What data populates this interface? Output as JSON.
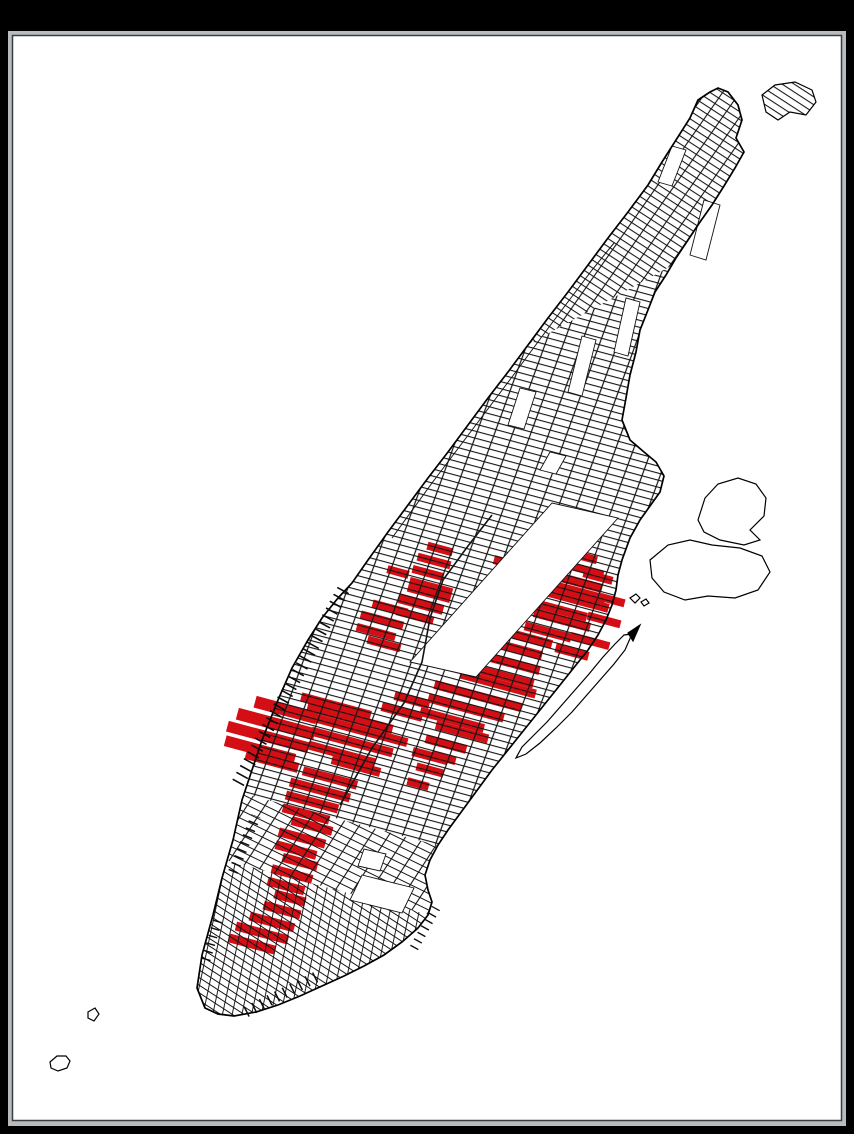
{
  "window": {
    "frame_color": "#000000",
    "bezel_color": "#b9bcbe",
    "bezel_edge_color": "#3a3d41",
    "canvas_color": "#ffffff"
  },
  "map": {
    "description": "street-network-map-of-manhattan-with-red-highlighted-blocks",
    "colors": {
      "street_line": "#141414",
      "coastline": "#000000",
      "highlight_red": "#d40e15",
      "park_fill": "#ffffff"
    },
    "coastline": [
      [
        205,
        1008
      ],
      [
        197,
        988
      ],
      [
        202,
        955
      ],
      [
        213,
        915
      ],
      [
        222,
        878
      ],
      [
        233,
        840
      ],
      [
        242,
        800
      ],
      [
        252,
        770
      ],
      [
        262,
        740
      ],
      [
        278,
        700
      ],
      [
        292,
        668
      ],
      [
        308,
        640
      ],
      [
        322,
        618
      ],
      [
        338,
        598
      ],
      [
        352,
        583
      ],
      [
        368,
        560
      ],
      [
        388,
        532
      ],
      [
        408,
        505
      ],
      [
        428,
        478
      ],
      [
        448,
        452
      ],
      [
        468,
        425
      ],
      [
        488,
        398
      ],
      [
        508,
        372
      ],
      [
        528,
        345
      ],
      [
        548,
        318
      ],
      [
        568,
        292
      ],
      [
        588,
        265
      ],
      [
        608,
        238
      ],
      [
        628,
        212
      ],
      [
        648,
        185
      ],
      [
        662,
        162
      ],
      [
        676,
        140
      ],
      [
        690,
        118
      ],
      [
        698,
        100
      ],
      [
        710,
        92
      ],
      [
        718,
        88
      ],
      [
        728,
        92
      ],
      [
        738,
        105
      ],
      [
        742,
        120
      ],
      [
        736,
        138
      ],
      [
        744,
        152
      ],
      [
        735,
        168
      ],
      [
        724,
        186
      ],
      [
        712,
        205
      ],
      [
        700,
        222
      ],
      [
        688,
        240
      ],
      [
        676,
        258
      ],
      [
        666,
        275
      ],
      [
        655,
        292
      ],
      [
        648,
        310
      ],
      [
        640,
        330
      ],
      [
        636,
        352
      ],
      [
        630,
        375
      ],
      [
        626,
        398
      ],
      [
        622,
        420
      ],
      [
        630,
        440
      ],
      [
        644,
        452
      ],
      [
        656,
        462
      ],
      [
        664,
        476
      ],
      [
        660,
        492
      ],
      [
        650,
        506
      ],
      [
        640,
        520
      ],
      [
        630,
        538
      ],
      [
        622,
        560
      ],
      [
        618,
        575
      ],
      [
        616,
        590
      ],
      [
        612,
        605
      ],
      [
        606,
        620
      ],
      [
        598,
        635
      ],
      [
        588,
        650
      ],
      [
        576,
        665
      ],
      [
        564,
        680
      ],
      [
        552,
        695
      ],
      [
        540,
        710
      ],
      [
        528,
        725
      ],
      [
        516,
        740
      ],
      [
        504,
        755
      ],
      [
        492,
        770
      ],
      [
        481,
        785
      ],
      [
        470,
        800
      ],
      [
        459,
        815
      ],
      [
        448,
        830
      ],
      [
        438,
        845
      ],
      [
        430,
        860
      ],
      [
        425,
        875
      ],
      [
        428,
        890
      ],
      [
        432,
        902
      ],
      [
        428,
        915
      ],
      [
        418,
        928
      ],
      [
        402,
        942
      ],
      [
        384,
        955
      ],
      [
        364,
        966
      ],
      [
        344,
        976
      ],
      [
        322,
        986
      ],
      [
        300,
        996
      ],
      [
        278,
        1005
      ],
      [
        256,
        1012
      ],
      [
        234,
        1016
      ],
      [
        218,
        1014
      ]
    ],
    "red_blocks": [
      [
        566,
        552,
        64,
        8
      ],
      [
        536,
        545,
        30,
        8
      ],
      [
        560,
        563,
        90,
        8
      ],
      [
        548,
        574,
        112,
        9
      ],
      [
        556,
        586,
        102,
        9
      ],
      [
        566,
        597,
        88,
        9
      ],
      [
        552,
        608,
        72,
        9
      ],
      [
        562,
        620,
        58,
        9
      ],
      [
        548,
        632,
        48,
        9
      ],
      [
        598,
        577,
        30,
        8
      ],
      [
        612,
        600,
        26,
        8
      ],
      [
        604,
        620,
        34,
        8
      ],
      [
        590,
        641,
        40,
        8
      ],
      [
        572,
        652,
        34,
        9
      ],
      [
        520,
        636,
        66,
        9
      ],
      [
        513,
        648,
        60,
        9
      ],
      [
        500,
        660,
        82,
        9
      ],
      [
        488,
        672,
        94,
        9
      ],
      [
        498,
        684,
        78,
        9
      ],
      [
        478,
        696,
        90,
        9
      ],
      [
        466,
        708,
        78,
        9
      ],
      [
        452,
        720,
        66,
        9
      ],
      [
        462,
        732,
        54,
        9
      ],
      [
        446,
        744,
        42,
        9
      ],
      [
        430,
        756,
        36,
        9
      ],
      [
        440,
        549,
        26,
        8
      ],
      [
        434,
        561,
        34,
        8
      ],
      [
        428,
        573,
        32,
        8
      ],
      [
        430,
        590,
        44,
        15
      ],
      [
        421,
        604,
        46,
        10
      ],
      [
        415,
        616,
        38,
        8
      ],
      [
        398,
        572,
        22,
        8
      ],
      [
        390,
        608,
        36,
        8
      ],
      [
        382,
        620,
        44,
        8
      ],
      [
        376,
        632,
        40,
        8
      ],
      [
        384,
        644,
        34,
        8
      ],
      [
        286,
        710,
        64,
        12
      ],
      [
        276,
        724,
        80,
        12
      ],
      [
        268,
        737,
        84,
        11
      ],
      [
        260,
        750,
        72,
        11
      ],
      [
        272,
        761,
        54,
        10
      ],
      [
        336,
        706,
        72,
        9
      ],
      [
        350,
        718,
        88,
        9
      ],
      [
        360,
        730,
        98,
        9
      ],
      [
        352,
        742,
        84,
        9
      ],
      [
        342,
        754,
        68,
        9
      ],
      [
        356,
        766,
        50,
        9
      ],
      [
        402,
        712,
        42,
        9
      ],
      [
        412,
        700,
        36,
        9
      ],
      [
        330,
        778,
        56,
        9
      ],
      [
        320,
        790,
        62,
        9
      ],
      [
        312,
        802,
        54,
        9
      ],
      [
        306,
        814,
        48,
        9
      ],
      [
        312,
        826,
        42,
        9
      ],
      [
        302,
        838,
        48,
        9
      ],
      [
        296,
        850,
        42,
        9
      ],
      [
        300,
        862,
        36,
        9
      ],
      [
        292,
        874,
        42,
        9
      ],
      [
        286,
        886,
        38,
        9
      ],
      [
        290,
        898,
        32,
        9
      ],
      [
        282,
        910,
        38,
        9
      ],
      [
        272,
        922,
        46,
        9
      ],
      [
        262,
        933,
        54,
        9
      ],
      [
        252,
        944,
        48,
        9
      ],
      [
        430,
        770,
        28,
        8
      ],
      [
        444,
        758,
        24,
        8
      ],
      [
        418,
        784,
        22,
        8
      ]
    ],
    "parks": [
      {
        "name": "central-park",
        "points": [
          [
            410,
            662
          ],
          [
            476,
            677
          ],
          [
            618,
            518
          ],
          [
            552,
            503
          ]
        ]
      },
      {
        "name": "morningside-park",
        "points": [
          [
            568,
            392
          ],
          [
            582,
            396
          ],
          [
            596,
            340
          ],
          [
            582,
            336
          ]
        ]
      },
      {
        "name": "st-nicholas-park",
        "points": [
          [
            614,
            352
          ],
          [
            628,
            356
          ],
          [
            640,
            302
          ],
          [
            626,
            298
          ]
        ]
      },
      {
        "name": "highbridge-park",
        "points": [
          [
            690,
            255
          ],
          [
            706,
            260
          ],
          [
            720,
            205
          ],
          [
            704,
            200
          ]
        ]
      },
      {
        "name": "fort-tryon-park",
        "points": [
          [
            658,
            182
          ],
          [
            672,
            186
          ],
          [
            686,
            150
          ],
          [
            672,
            146
          ]
        ]
      },
      {
        "name": "campus-block",
        "points": [
          [
            508,
            425
          ],
          [
            524,
            429
          ],
          [
            536,
            392
          ],
          [
            520,
            388
          ]
        ]
      },
      {
        "name": "stuyvesant-town",
        "points": [
          [
            350,
            900
          ],
          [
            402,
            913
          ],
          [
            414,
            888
          ],
          [
            362,
            875
          ]
        ]
      },
      {
        "name": "tompkins-square",
        "points": [
          [
            358,
            866
          ],
          [
            380,
            871
          ],
          [
            386,
            854
          ],
          [
            364,
            849
          ]
        ]
      },
      {
        "name": "marcus-garvey-park",
        "points": [
          [
            540,
            470
          ],
          [
            556,
            474
          ],
          [
            566,
            456
          ],
          [
            550,
            452
          ]
        ]
      }
    ],
    "satellite_islands": [
      {
        "name": "marble-hill",
        "points": [
          [
            762,
            95
          ],
          [
            775,
            85
          ],
          [
            795,
            82
          ],
          [
            812,
            90
          ],
          [
            816,
            102
          ],
          [
            806,
            115
          ],
          [
            790,
            112
          ],
          [
            778,
            120
          ],
          [
            766,
            112
          ]
        ],
        "pattern": "pat-st-top"
      },
      {
        "name": "wards-island",
        "points": [
          [
            650,
            560
          ],
          [
            668,
            545
          ],
          [
            690,
            540
          ],
          [
            712,
            545
          ],
          [
            740,
            548
          ],
          [
            762,
            556
          ],
          [
            770,
            572
          ],
          [
            758,
            590
          ],
          [
            735,
            598
          ],
          [
            708,
            596
          ],
          [
            685,
            600
          ],
          [
            664,
            592
          ],
          [
            652,
            578
          ]
        ]
      },
      {
        "name": "randalls-island",
        "points": [
          [
            698,
            520
          ],
          [
            705,
            498
          ],
          [
            718,
            484
          ],
          [
            738,
            478
          ],
          [
            756,
            484
          ],
          [
            766,
            498
          ],
          [
            764,
            516
          ],
          [
            750,
            530
          ],
          [
            760,
            540
          ],
          [
            744,
            545
          ],
          [
            720,
            540
          ],
          [
            704,
            532
          ]
        ]
      },
      {
        "name": "roosevelt-sliver",
        "points": [
          [
            632,
            634
          ],
          [
            625,
            650
          ],
          [
            614,
            664
          ],
          [
            600,
            680
          ],
          [
            586,
            696
          ],
          [
            572,
            712
          ],
          [
            556,
            728
          ],
          [
            540,
            743
          ],
          [
            526,
            754
          ],
          [
            516,
            758
          ],
          [
            522,
            747
          ],
          [
            533,
            736
          ],
          [
            547,
            722
          ],
          [
            561,
            706
          ],
          [
            575,
            690
          ],
          [
            589,
            674
          ],
          [
            603,
            657
          ],
          [
            615,
            644
          ],
          [
            624,
            635
          ]
        ]
      },
      {
        "name": "sliver-arrow-tip",
        "points": [
          [
            628,
            633
          ],
          [
            640,
            625
          ],
          [
            633,
            641
          ]
        ],
        "fill": "#000000"
      },
      {
        "name": "liberty-island",
        "points": [
          [
            50,
            1062
          ],
          [
            57,
            1056
          ],
          [
            66,
            1056
          ],
          [
            70,
            1061
          ],
          [
            67,
            1068
          ],
          [
            58,
            1071
          ],
          [
            51,
            1068
          ]
        ]
      },
      {
        "name": "ellis-island",
        "points": [
          [
            88,
            1012
          ],
          [
            95,
            1008
          ],
          [
            99,
            1014
          ],
          [
            94,
            1021
          ],
          [
            88,
            1018
          ]
        ]
      },
      {
        "name": "pond-1",
        "points": [
          [
            630,
            598
          ],
          [
            636,
            594
          ],
          [
            640,
            598
          ],
          [
            635,
            603
          ]
        ]
      },
      {
        "name": "pond-2",
        "points": [
          [
            641,
            602
          ],
          [
            646,
            599
          ],
          [
            649,
            603
          ],
          [
            644,
            606
          ]
        ]
      }
    ],
    "piers": [
      {
        "name": "hudson-midtown-piers",
        "x1": 238,
        "y1": 783,
        "x2": 346,
        "y2": 585,
        "w": 13,
        "dash": "1.6 6.2"
      },
      {
        "name": "west-village-piers",
        "x1": 233,
        "y1": 872,
        "x2": 256,
        "y2": 816,
        "w": 10,
        "dash": "1.5 6"
      },
      {
        "name": "lower-west-piers",
        "x1": 206,
        "y1": 960,
        "x2": 219,
        "y2": 916,
        "w": 9,
        "dash": "1.4 6.5"
      },
      {
        "name": "battery-east-piers",
        "x1": 246,
        "y1": 1012,
        "x2": 318,
        "y2": 976,
        "w": 11,
        "dash": "1.5 7"
      },
      {
        "name": "corlears-hook-piers",
        "x1": 414,
        "y1": 948,
        "x2": 436,
        "y2": 908,
        "w": 9,
        "dash": "1.4 6"
      }
    ],
    "routes": [
      {
        "name": "broadway-diagonal",
        "points": [
          [
            340,
            805
          ],
          [
            372,
            748
          ],
          [
            404,
            703
          ],
          [
            422,
            662
          ],
          [
            430,
            618
          ],
          [
            443,
            580
          ],
          [
            468,
            546
          ],
          [
            492,
            515
          ]
        ],
        "w": 1.6
      },
      {
        "name": "riverside-shore-line",
        "points": [
          [
            392,
            538
          ],
          [
            432,
            483
          ],
          [
            472,
            430
          ],
          [
            512,
            377
          ],
          [
            552,
            323
          ],
          [
            592,
            270
          ],
          [
            614,
            243
          ]
        ],
        "w": 1.0
      }
    ]
  }
}
